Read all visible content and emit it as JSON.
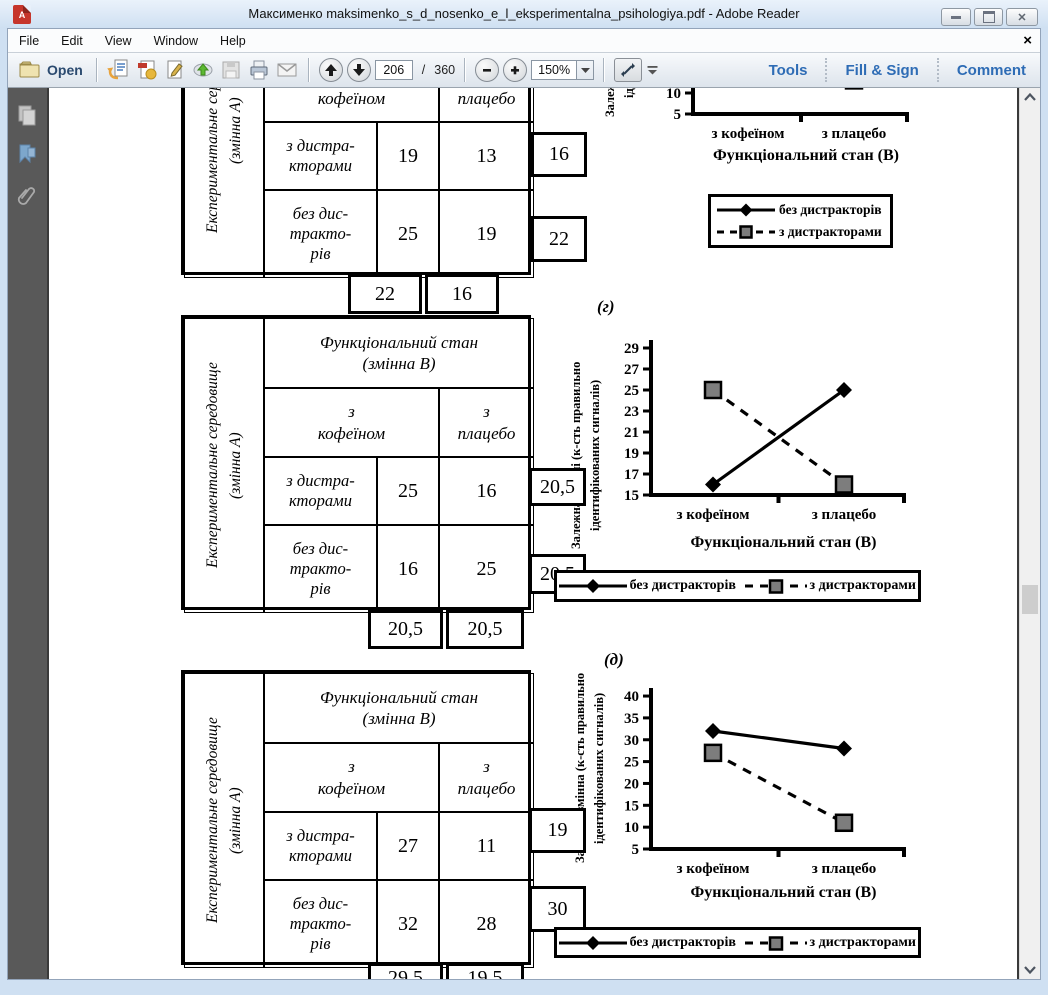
{
  "window": {
    "title": "Максименко maksimenko_s_d_nosenko_e_l_eksperimentalna_psihologiya.pdf - Adobe Reader",
    "menu": [
      "File",
      "Edit",
      "View",
      "Window",
      "Help"
    ],
    "menu_close": "×"
  },
  "toolbar": {
    "open": "Open",
    "page_current": "206",
    "page_sep": "/",
    "page_total": "360",
    "zoom": "150%",
    "tabs": [
      "Tools",
      "Fill & Sign",
      "Comment"
    ]
  },
  "icons": {
    "titlebar": "pdf-logo",
    "window_buttons": [
      "minimize",
      "restore",
      "close"
    ],
    "toolbar": [
      "open-folder",
      "previous-view-doc",
      "create-pdf-doc",
      "sign-doc",
      "upload-cloud",
      "save-floppy",
      "print",
      "email-envelope",
      "page-up",
      "page-down",
      "zoom-out",
      "zoom-in",
      "fit-width",
      "toolbar-overflow"
    ],
    "sidebar": [
      "page-thumbnails",
      "bookmarks",
      "attachments"
    ]
  },
  "figure_labels": {
    "g": "(г)",
    "d": "(д)"
  },
  "table_common": {
    "side": "Експериментальне середовище\n(змінна А)",
    "header": "Функціональний стан\n(змінна В)",
    "col1": "з\nкофеїном",
    "col2": "з\nплацебо",
    "row1": "з дистра-\nкторами",
    "row2": "без дис-\nтракто-\nрів"
  },
  "tables": [
    {
      "values": [
        [
          "19",
          "13"
        ],
        [
          "25",
          "19"
        ]
      ],
      "row_margins": [
        "16",
        "22"
      ],
      "col_margins": [
        "22",
        "16"
      ]
    },
    {
      "values": [
        [
          "25",
          "16"
        ],
        [
          "16",
          "25"
        ]
      ],
      "row_margins": [
        "20,5",
        "20,5"
      ],
      "col_margins": [
        "20,5",
        "20,5"
      ]
    },
    {
      "values": [
        [
          "27",
          "11"
        ],
        [
          "32",
          "28"
        ]
      ],
      "row_margins": [
        "19",
        "30"
      ],
      "col_margins": [
        "29,5",
        "19,5"
      ]
    }
  ],
  "legend": {
    "solid": "без дистракторів",
    "dashed": "з дистракторами"
  },
  "chart_data": [
    {
      "id": "chart-top",
      "type": "line",
      "categories": [
        "з кофеїном",
        "з плацебо"
      ],
      "series": [
        {
          "name": "без дистракторів",
          "style": "solid-diamond",
          "values": [
            25,
            19
          ]
        },
        {
          "name": "з дистракторами",
          "style": "dashed-square",
          "values": [
            19,
            13
          ]
        }
      ],
      "ylim": [
        5,
        30
      ],
      "yticks": [
        5,
        10,
        15,
        20,
        25,
        30
      ],
      "xlabel": "Функціональний стан (В)",
      "ylabel": "Залежна змінна (к-сть правильно\nідентифікованих сигналів)",
      "legend_position": "boxed-below-vertical"
    },
    {
      "id": "chart-g",
      "type": "line",
      "categories": [
        "з кофеїном",
        "з плацебо"
      ],
      "series": [
        {
          "name": "без дистракторів",
          "style": "solid-diamond",
          "values": [
            16,
            25
          ]
        },
        {
          "name": "з дистракторами",
          "style": "dashed-square",
          "values": [
            25,
            16
          ]
        }
      ],
      "ylim": [
        15,
        29
      ],
      "yticks": [
        15,
        17,
        19,
        21,
        23,
        25,
        27,
        29
      ],
      "xlabel": "Функціональний стан (В)",
      "ylabel": "Залежна змінні (к-сть правильно\nідентифікованих сигналів)",
      "legend_position": "boxed-below-horizontal"
    },
    {
      "id": "chart-d",
      "type": "line",
      "categories": [
        "з кофеїном",
        "з плацебо"
      ],
      "series": [
        {
          "name": "без дистракторів",
          "style": "solid-diamond",
          "values": [
            32,
            28
          ]
        },
        {
          "name": "з дистракторами",
          "style": "dashed-square",
          "values": [
            27,
            11
          ]
        }
      ],
      "ylim": [
        5,
        40
      ],
      "yticks": [
        5,
        10,
        15,
        20,
        25,
        30,
        35,
        40
      ],
      "xlabel": "Функціональний стан (В)",
      "ylabel": "Залежна змінна (к-сть правильно\nідентифікованих сигналів)",
      "legend_position": "boxed-below-horizontal"
    }
  ]
}
